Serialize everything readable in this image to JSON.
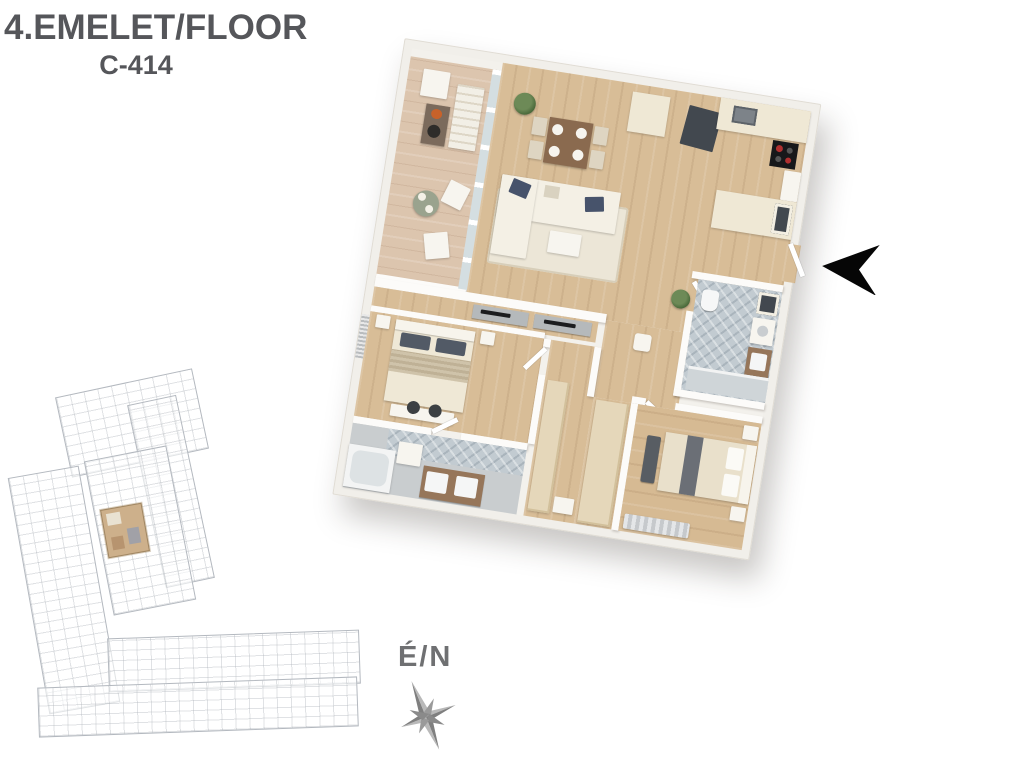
{
  "header": {
    "title": "4.EMELET/FLOOR",
    "unit_code": "C-414",
    "text_color": "#55565a"
  },
  "compass": {
    "label": "É/N",
    "label_color": "#6f7072",
    "rose_color": "#8f8f8f"
  },
  "entrance": {
    "indicator": "black-arrow",
    "direction": "left",
    "color": "#000000"
  },
  "floor_plan": {
    "view": "3d-top-down-render",
    "rotation_deg": 9,
    "rooms": [
      "balcony",
      "living-dining-kitchen",
      "entry",
      "hallway",
      "bedroom-1",
      "bathroom-1",
      "dressing-corridor",
      "bathroom-2",
      "bedroom-2"
    ],
    "furniture": [
      "outdoor-lounge-set",
      "outdoor-bistro-table",
      "dining-table-4-chairs",
      "l-shaped-sofa",
      "coffee-table",
      "kitchen-counter",
      "kitchen-island",
      "bar-stools",
      "cooktop",
      "sink",
      "sideboard",
      "double-bed-1",
      "double-bed-2",
      "bed-bench",
      "double-vanity",
      "bathtub",
      "washing-machine",
      "shower",
      "toilet",
      "wardrobes",
      "plants",
      "rug",
      "pouf"
    ],
    "colors": {
      "wood_floor": "#d8bd97",
      "balcony_floor": "#dcc5ae",
      "wall": "#f1efea",
      "tile": "#c9cdcf",
      "herringbone_tile": "#c2cbd1",
      "wardrobe": "#e5d7ba",
      "accent_pillow": "#47536b",
      "vanity_wood": "#96765a"
    }
  },
  "site_plan": {
    "type": "building-overview-outline",
    "highlight_color": "#cdb08b",
    "line_color": "#868e98"
  }
}
